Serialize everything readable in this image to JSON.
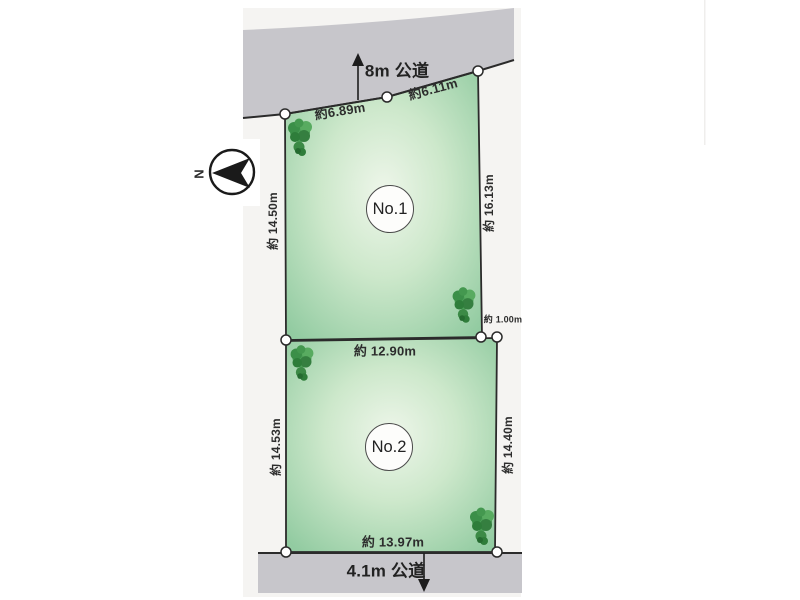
{
  "compass": {
    "north_label": "N"
  },
  "roads": {
    "top_label": "8m 公道",
    "bottom_label": "4.1m 公道"
  },
  "plot1": {
    "label": "No.1",
    "top_segment_left": "約6.89m",
    "top_segment_right": "約6.11m",
    "left_side": "約 14.50m",
    "right_side": "約 16.13m",
    "bottom_side": "約 12.90m"
  },
  "plot2": {
    "label": "No.2",
    "left_side": "約 14.53m",
    "right_side": "約 14.40m",
    "bottom_side": "約 13.97m",
    "right_offset": "約 1.00m"
  },
  "colors": {
    "road_gray": "#c7c6cb",
    "outline": "#2b2b2b",
    "plot_center": "#eef6ea",
    "plot_mid": "#cde8cb",
    "plot_edge": "#92cba1",
    "canvas": "#f5f4f2"
  }
}
